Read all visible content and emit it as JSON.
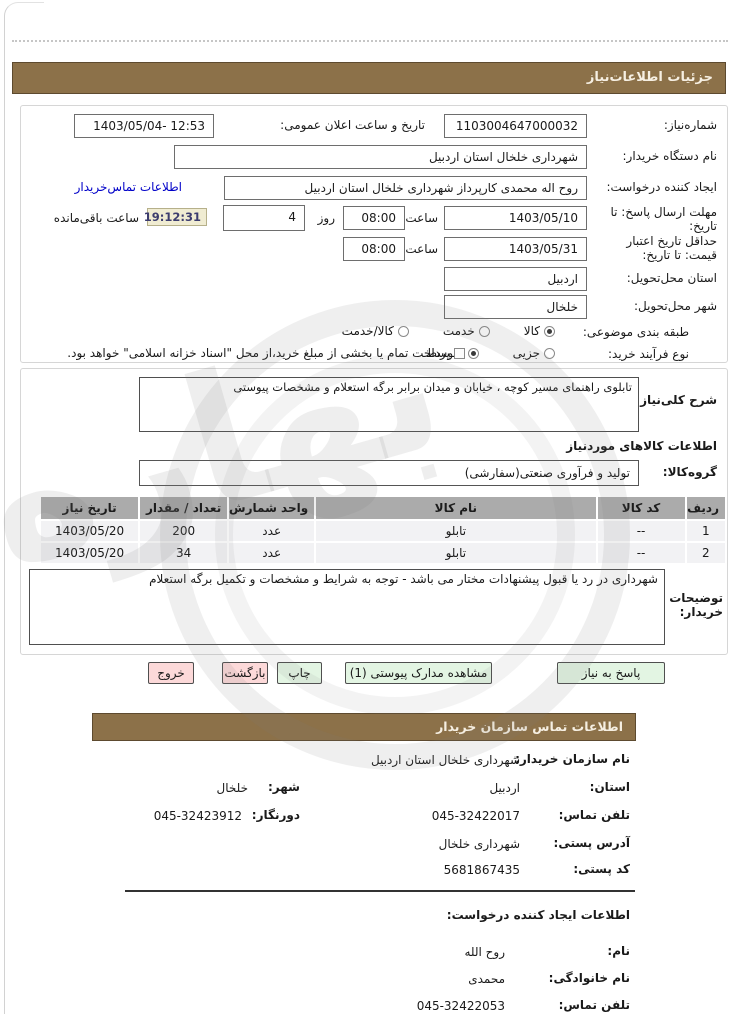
{
  "titles": {
    "need_details": "جزئیات اطلاعات‌نیاز",
    "buyer_contact": "اطلاعات تماس  سازمان خریدار"
  },
  "watermark": {
    "text": "بهاره"
  },
  "form": {
    "need_number_label": "شماره‌نیاز:",
    "need_number": "1103004647000032",
    "announce_label": "تاریخ و ساعت اعلان عمومی:",
    "announce_value": "1403/05/04- 12:53",
    "org_label": "نام دستگاه خریدار:",
    "org_value": "شهرداری خلخال استان اردبیل",
    "creator_label": "ایجاد کننده درخواست:",
    "creator_value": "روح اله محمدی کارپرداز  شهرداری خلخال استان اردبیل",
    "creator_link": "اطلاعات تماس‌خریدار",
    "deadline_label": "مهلت ارسال پاسخ: تا تاریخ:",
    "deadline_date": "1403/05/10",
    "hour_label": "ساعت",
    "deadline_hour": "08:00",
    "day_label": "روز",
    "days_value": "4",
    "countdown": "19:12:31",
    "remaining_label": "ساعت باقی‌مانده",
    "validity_label": "حداقل تاریخ اعتبار قیمت: تا تاریخ:",
    "validity_date": "1403/05/31",
    "validity_hour": "08:00",
    "province_label": "استان محل‌تحویل:",
    "province_value": "اردبیل",
    "city_label": "شهر محل‌تحویل:",
    "city_value": "خلخال",
    "classification_label": "طبقه بندی موضوعی:",
    "class_opt_goods": "کالا",
    "class_opt_service": "خدمت",
    "class_opt_both": "کالا/خدمت",
    "process_label": "نوع فرآیند خرید:",
    "proc_opt_partial": "جزیی",
    "proc_opt_medium": "متوسط",
    "treasury_checkbox": "پرداخت تمام یا بخشی از مبلغ خرید،از محل \"اسناد خزانه اسلامی\" خواهد بود."
  },
  "needs": {
    "desc_label": "شرح کلی‌نیاز:",
    "desc_value": "تابلوی راهنمای مسیر کوچه ، خیابان و میدان برابر برگه استعلام و مشخصات پیوستی",
    "goods_header": "اطلاعات  کالاهای موردنیاز",
    "group_label": "گروه‌کالا:",
    "group_value": "تولید و  فرآوری  صنعتی(سفارشی)",
    "table": {
      "headers": [
        "ردیف",
        "کد کالا",
        "نام کالا",
        "واحد شمارش",
        "تعداد / مقدار",
        "تاریخ نیاز"
      ],
      "rows": [
        [
          "1",
          "--",
          "تابلو",
          "عدد",
          "200",
          "1403/05/20"
        ],
        [
          "2",
          "--",
          "تابلو",
          "عدد",
          "34",
          "1403/05/20"
        ]
      ]
    },
    "notes_label": "توضیحات خریدار:",
    "notes_value": "شهرداری در رد یا قبول پیشنهادات مختار می باشد - توجه به شرایط و مشخصات و تکمیل برگه استعلام"
  },
  "buttons": {
    "respond": "پاسخ به نیاز",
    "view_docs": "مشاهده مدارک پیوستی (1)",
    "print": "چاپ",
    "back": "بازگشت",
    "exit": "خروج"
  },
  "contact": {
    "org_label": "نام سازمان خریدار:",
    "org_value": "شهرداری خلخال استان اردبیل",
    "province_label": "استان:",
    "province_value": "اردبیل",
    "city_label": "شهر:",
    "city_value": "خلخال",
    "phone_label": "تلفن تماس:",
    "phone_value": "045-32422017",
    "fax_label": "دورنگار:",
    "fax_value": "045-32423912",
    "address_label": "آدرس پستی:",
    "address_value": "شهرداری خلخال",
    "postal_label": "کد پستی:",
    "postal_value": "5681867435"
  },
  "creator_info": {
    "header": "اطلاعات ایجاد کننده درخواست:",
    "name_label": "نام:",
    "name_value": "روح الله",
    "family_label": "نام خانوادگی:",
    "family_value": "محمدی",
    "phone_label": "تلفن تماس:",
    "phone_value": "045-32422053"
  }
}
